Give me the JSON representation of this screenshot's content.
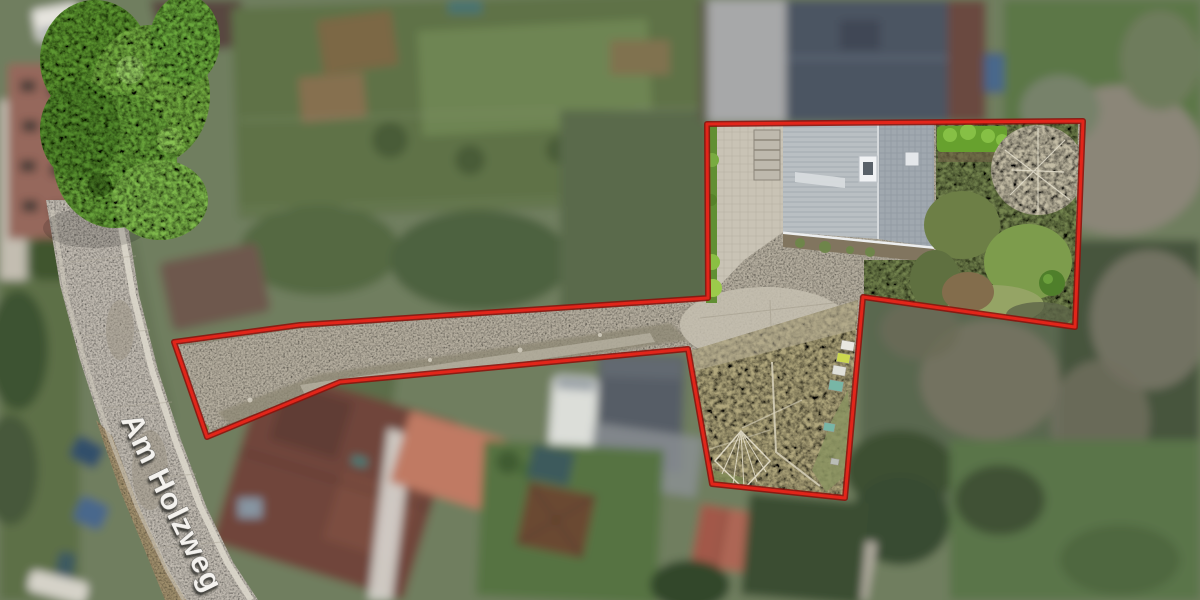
{
  "street_label": "Am Holzweg",
  "label_color": "#f4f2ee",
  "boundary": {
    "points": "707,124 1083,121 1075,327 863,297 845,498 712,484 688,349 340,382 207,437 174,342 300,325 708,298",
    "color": "#e2251a",
    "outline_color": "#8c130c",
    "stroke_width": "3"
  },
  "palette": {
    "road": "#c0bab0",
    "road_shoulder": "#a5916e",
    "gravel": "#b5ae9f",
    "meadow": "#b1a77d",
    "roof_main_light": "#b9bfc3",
    "roof_main_dark": "#a0a8af",
    "neighbor_roof": "#4c5462",
    "vegetation_base": "#6f7e5f",
    "tree_canopy": "#74ad42",
    "hedge_green": "#67a12e"
  }
}
